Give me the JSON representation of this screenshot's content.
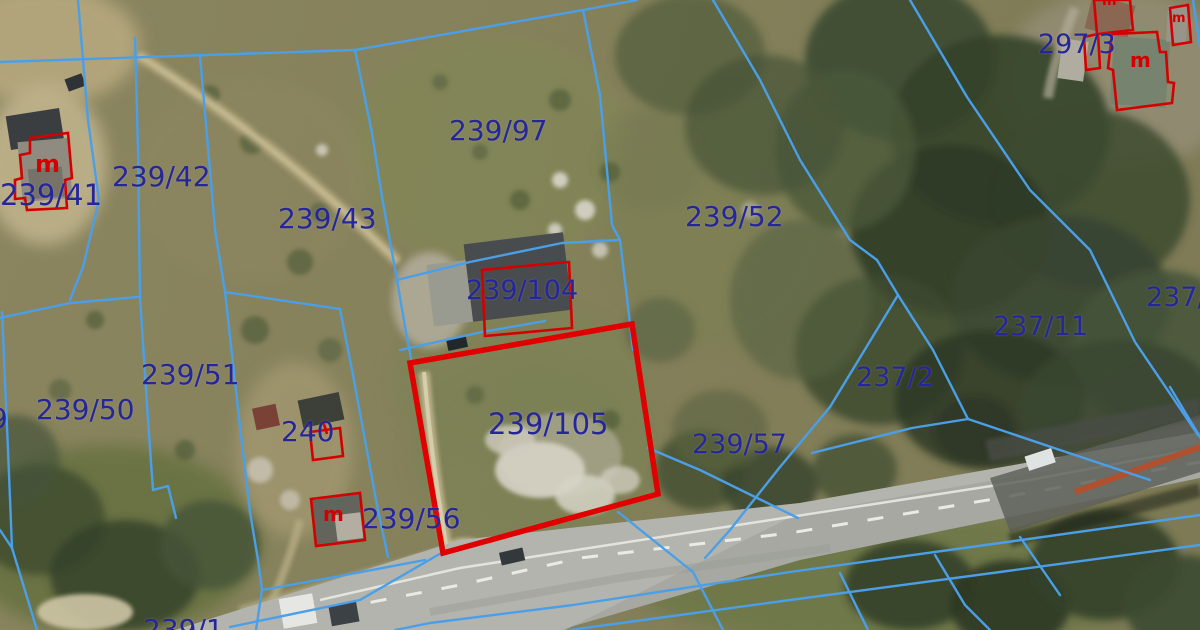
{
  "map": {
    "description": "Cadastral parcel boundary overlay on aerial orthophoto with highlighted parcel",
    "highlighted_parcel": "239/105",
    "colors": {
      "boundary_line": "#4a9fe8",
      "parcel_label": "#26269b",
      "building_outline": "#d40000",
      "highlight_outline": "#e00000"
    },
    "parcel_labels": [
      {
        "text": "239/42",
        "x": 112,
        "y": 163,
        "fs": 28
      },
      {
        "text": "239/41",
        "x": 0,
        "y": 181,
        "fs": 29
      },
      {
        "text": "239/43",
        "x": 278,
        "y": 205,
        "fs": 28
      },
      {
        "text": "239/97",
        "x": 449,
        "y": 117,
        "fs": 28
      },
      {
        "text": "239/52",
        "x": 685,
        "y": 203,
        "fs": 28
      },
      {
        "text": "297/3",
        "x": 1038,
        "y": 31,
        "fs": 27
      },
      {
        "text": "239/104",
        "x": 466,
        "y": 277,
        "fs": 27
      },
      {
        "text": "239/105",
        "x": 488,
        "y": 410,
        "fs": 29
      },
      {
        "text": "237/2",
        "x": 856,
        "y": 364,
        "fs": 27
      },
      {
        "text": "237/11",
        "x": 993,
        "y": 313,
        "fs": 27
      },
      {
        "text": "237/6",
        "x": 1146,
        "y": 284,
        "fs": 27
      },
      {
        "text": "239/57",
        "x": 692,
        "y": 431,
        "fs": 27
      },
      {
        "text": "239/50",
        "x": 36,
        "y": 396,
        "fs": 28
      },
      {
        "text": "239/51",
        "x": 141,
        "y": 361,
        "fs": 28
      },
      {
        "text": "240",
        "x": 281,
        "y": 418,
        "fs": 28
      },
      {
        "text": "239/56",
        "x": 362,
        "y": 505,
        "fs": 28
      },
      {
        "text": "239/1",
        "x": 143,
        "y": 616,
        "fs": 28
      },
      {
        "text": "9",
        "x": -10,
        "y": 405,
        "fs": 28
      }
    ],
    "building_marks": [
      {
        "text": "m",
        "x": 35,
        "y": 152,
        "fs": 24
      },
      {
        "text": "m",
        "x": 323,
        "y": 504,
        "fs": 20
      },
      {
        "text": "m",
        "x": 1130,
        "y": 50,
        "fs": 20
      },
      {
        "text": "m",
        "x": 1172,
        "y": 12,
        "fs": 13
      },
      {
        "text": "m",
        "x": 1102,
        "y": -6,
        "fs": 14
      }
    ]
  }
}
